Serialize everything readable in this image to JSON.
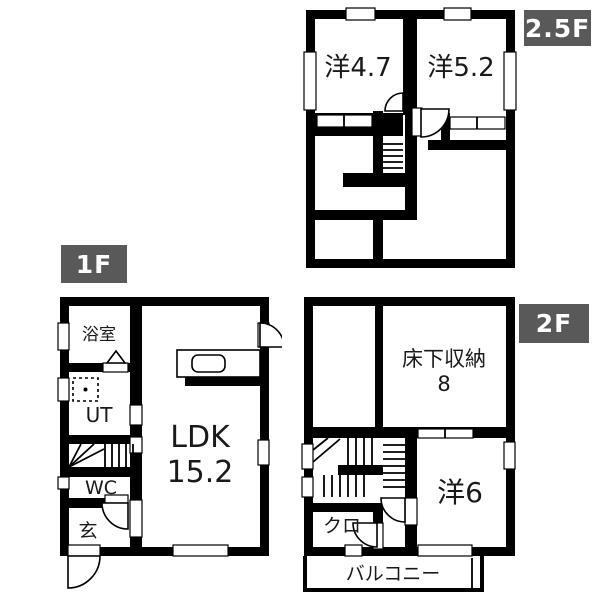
{
  "title": "house-floor-plan",
  "colors": {
    "wall": "#000000",
    "background": "#ffffff",
    "floor_label_bg": "#595959",
    "floor_label_text": "#ffffff"
  },
  "floors": [
    {
      "label": "2.5F",
      "rooms": [
        {
          "name": "洋4.7"
        },
        {
          "name": "洋5.2"
        }
      ]
    },
    {
      "label": "1F",
      "rooms": [
        {
          "name": "浴室"
        },
        {
          "name": "UT"
        },
        {
          "name": "WC"
        },
        {
          "name": "玄"
        },
        {
          "name": "LDK",
          "size": "15.2"
        }
      ]
    },
    {
      "label": "2F",
      "rooms": [
        {
          "name": "床下収納",
          "size": "8"
        },
        {
          "name": "洋6"
        },
        {
          "name": "クロ"
        },
        {
          "name": "バルコニー"
        }
      ]
    }
  ]
}
